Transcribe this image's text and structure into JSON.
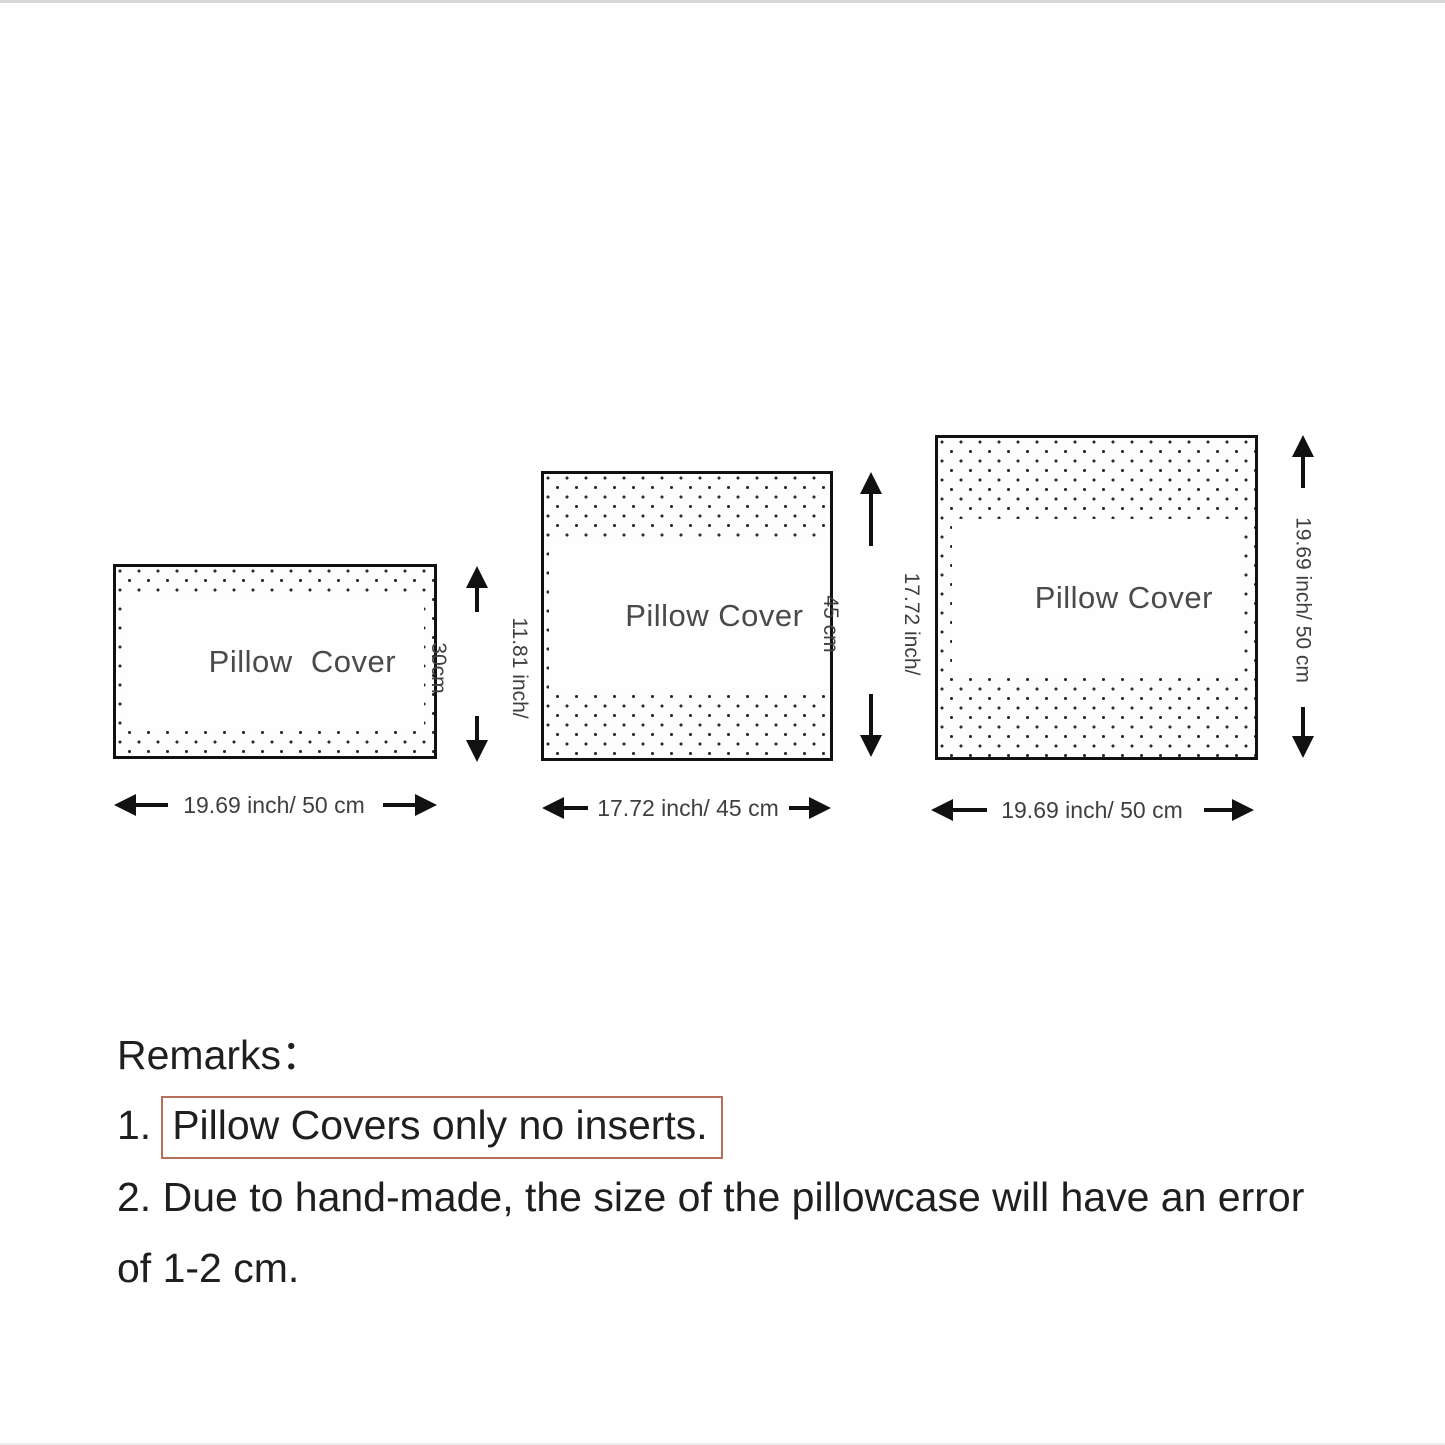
{
  "diagram": {
    "pillows": [
      {
        "name": "small rectangle pillow cover",
        "label": "Pillow  Cover",
        "width_label": "19.69 inch/ 50 cm",
        "height_lines": [
          "11.81 inch/",
          "30cm"
        ]
      },
      {
        "name": "medium square pillow cover",
        "label": "Pillow Cover",
        "width_label": "17.72 inch/ 45 cm",
        "height_lines": [
          "17.72 inch/",
          "45 cm"
        ]
      },
      {
        "name": "large square pillow cover",
        "label": "Pillow Cover",
        "width_label": "19.69 inch/ 50 cm",
        "height_lines": [
          "19.69 inch/ 50 cm"
        ]
      }
    ]
  },
  "remarks": {
    "title": "Remarks：",
    "item1_prefix": "1.",
    "item1_boxed": "Pillow Covers only no inserts.",
    "item2": "2. Due to hand-made, the size of the pillowcase will have an error",
    "item2_cont": "of 1-2 cm."
  },
  "colors": {
    "background": "#ffffff",
    "line": "#111111",
    "dot": "#2a2a2a",
    "pillow_label_text": "#4a4a4a",
    "dimension_text": "#3f3f3f",
    "remarks_text": "#1f1f1f",
    "highlight_border": "#b5705a"
  }
}
